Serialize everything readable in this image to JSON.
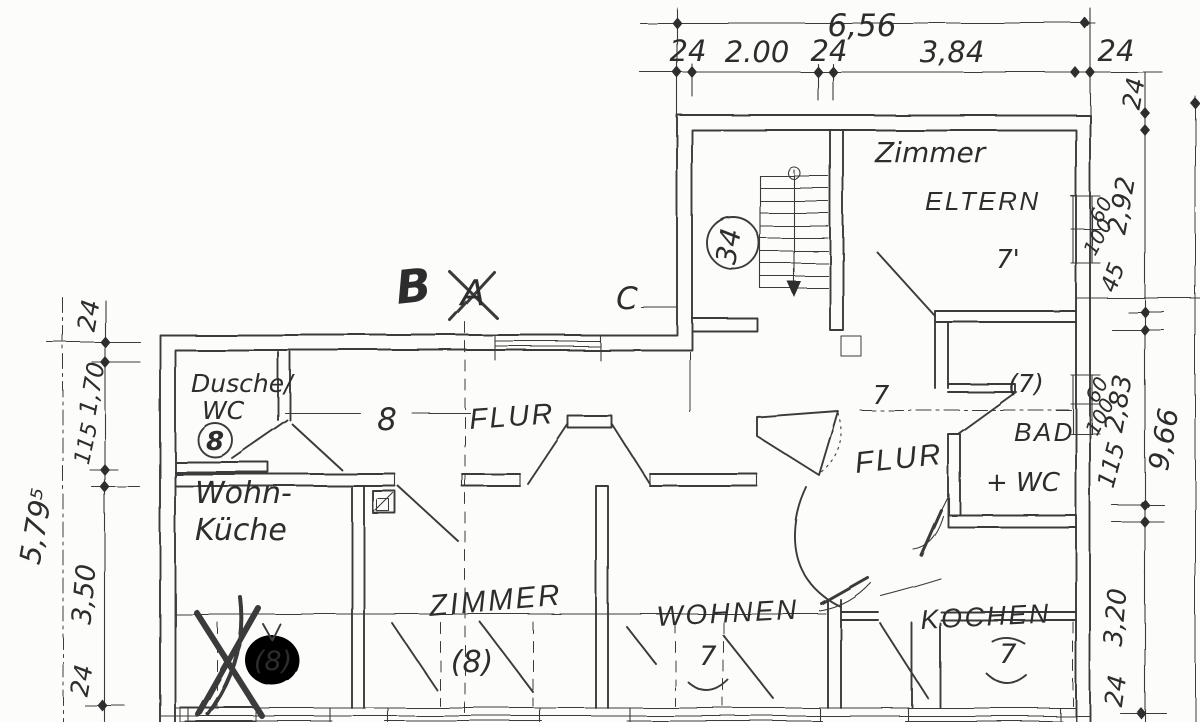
{
  "sections": {
    "b": "B",
    "a": "A",
    "c": "C"
  },
  "rooms": {
    "zimmer_eltern": {
      "line1": "Zimmer",
      "line2": "ELTERN",
      "number": "7'"
    },
    "stairs": {
      "number": "34"
    },
    "dusche_wc": {
      "line1": "Dusche/",
      "line2": "WC",
      "number": "8"
    },
    "flur_left": {
      "label": "FLUR",
      "number": "8"
    },
    "wohnkueche": {
      "line1": "Wohn-",
      "line2": "Küche",
      "number": "(8)"
    },
    "zimmer": {
      "label": "ZIMMER",
      "number": "(8)"
    },
    "wohnen": {
      "label": "WOHNEN",
      "number": "7"
    },
    "flur_right": {
      "label": "FLUR",
      "number": "7"
    },
    "bad_wc": {
      "line1": "BAD",
      "line2": "+ WC",
      "number": "(7)"
    },
    "kochen": {
      "label": "KOCHEN",
      "number": "7"
    }
  },
  "dims": {
    "top": {
      "total": "6,56",
      "p1": "24",
      "p2": "2.00",
      "p3": "24",
      "p4": "3,84",
      "p5": "24"
    },
    "right": {
      "s24": "24",
      "s292": "2,92",
      "w1a": "60",
      "w1b": "100",
      "s45": "45",
      "w2a": "60",
      "w2b": "100",
      "s283": "2,83",
      "s115": "115",
      "s320": "3,20",
      "s24b": "24",
      "outer": "9,66"
    },
    "left": {
      "s24": "24",
      "s170": "1,70",
      "s115": "115",
      "s350": "3,50",
      "s24b": "24",
      "outer": "5,79⁵"
    }
  }
}
